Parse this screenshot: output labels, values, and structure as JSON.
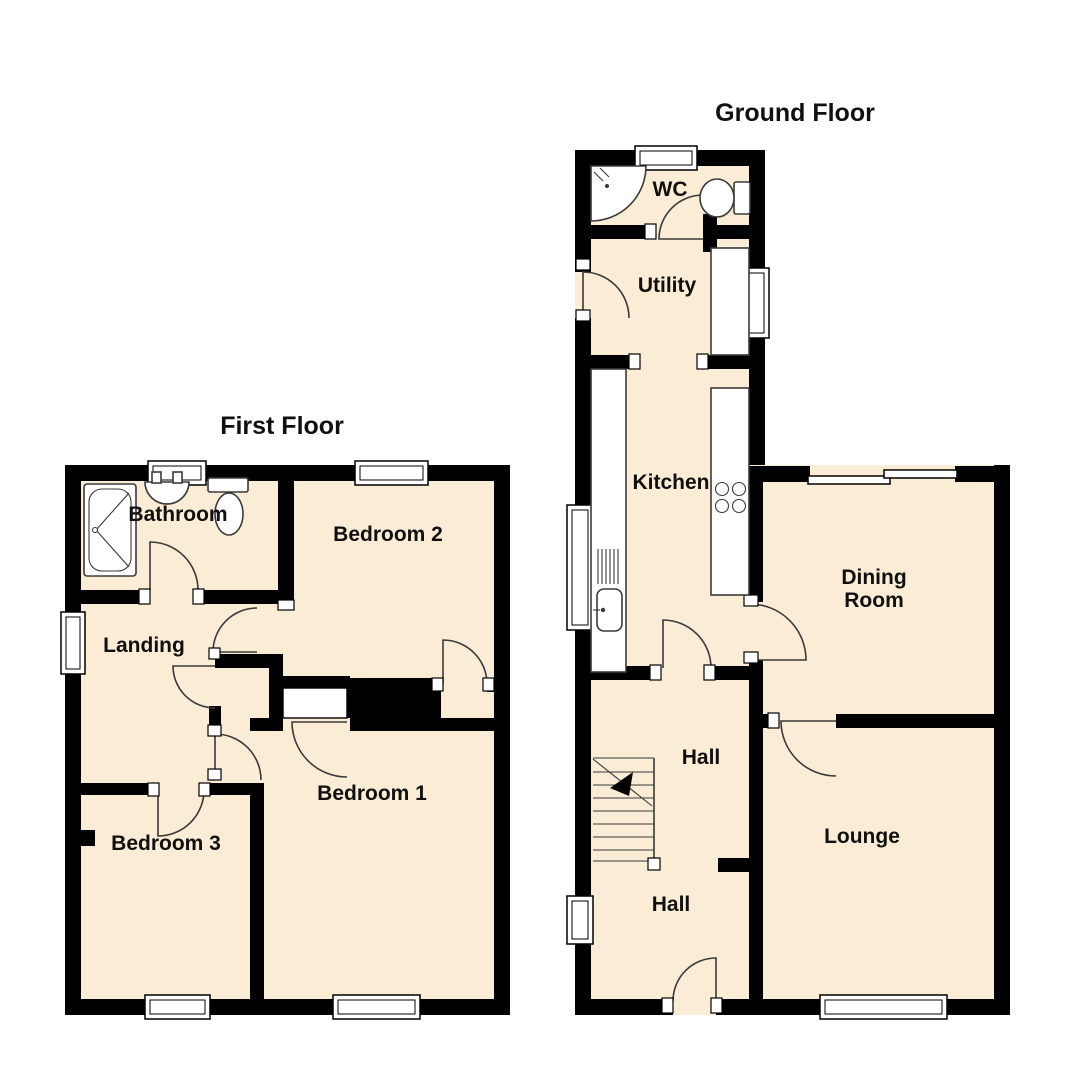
{
  "colors": {
    "bg": "#FFFFFF",
    "floor_fill": "#FAECD5",
    "wall": "#000000",
    "line": "#3A3A3A",
    "text": "#101010"
  },
  "floors": {
    "first": {
      "title": "First Floor",
      "rooms": {
        "bathroom": "Bathroom",
        "bedroom2": "Bedroom 2",
        "landing": "Landing",
        "bedroom3": "Bedroom 3",
        "bedroom1": "Bedroom 1"
      }
    },
    "ground": {
      "title": "Ground Floor",
      "rooms": {
        "wc": "WC",
        "utility": "Utility",
        "kitchen": "Kitchen",
        "dining_line1": "Dining",
        "dining_line2": "Room",
        "hall_upper": "Hall",
        "lounge": "Lounge",
        "hall_lower": "Hall"
      }
    }
  }
}
